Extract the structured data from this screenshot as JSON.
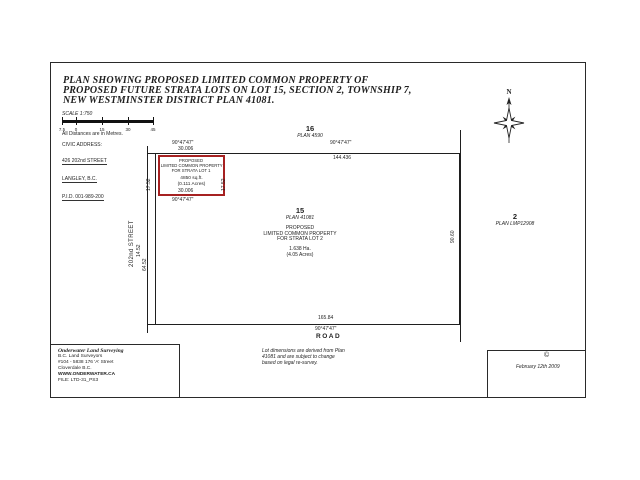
{
  "page": {
    "title_lines": [
      "PLAN SHOWING PROPOSED LIMITED COMMON PROPERTY OF",
      "PROPOSED FUTURE STRATA LOTS ON LOT 15, SECTION 2, TOWNSHIP 7,",
      "NEW WESTMINSTER DISTRICT PLAN 41081."
    ],
    "scale": {
      "label": "SCALE 1:750",
      "ticks": [
        "7.5",
        "0",
        "15",
        "30",
        "45"
      ],
      "note": "All Distances are in Metres."
    },
    "civic": {
      "heading": "CIVIC ADDRESS:",
      "lines": [
        "426 202nd STREET",
        "LANGLEY, B.C.",
        "P.I.D. 001-989-200"
      ]
    }
  },
  "drawing": {
    "north_label": "N",
    "street_label": "202nd STREET",
    "road_label": "ROAD",
    "parcel_north": {
      "number": "16",
      "plan": "PLAN 4590"
    },
    "parcel_east": {
      "number": "2",
      "plan": "PLAN LMP12908"
    },
    "lot15": {
      "number": "15",
      "plan": "PLAN 41081",
      "line1": "PROPOSED",
      "line2": "LIMITED COMMON PROPERTY",
      "line3": "FOR STRATA LOT 2",
      "area_ha": "1.638 Ha.",
      "area_acres": "(4.05 Acres)"
    },
    "lcp_lot1": {
      "line1": "PROPOSED",
      "line2": "LIMITED COMMON PROPERTY",
      "line3": "FOR STRATA LOT 1",
      "area": "4850 sq.ft.",
      "area_acres": "(0.111 Acres)",
      "outline_color": "#a62121"
    },
    "dims": {
      "top_bearing": "90°47'47\"",
      "top_distance": "144.436",
      "box_top_bearing": "90°47'47\"",
      "box_top_distance": "30.006",
      "box_bottom_distance": "30.006",
      "box_bottom_bearing": "90°47'47\"",
      "box_side_left": "17.52",
      "box_side_right": "17.52",
      "street_upper": "14.52",
      "street_lower": "64.52",
      "east_side": "90.60",
      "bottom_distance": "165.84",
      "bottom_bearing": "90°47'47\""
    }
  },
  "footer": {
    "surveyor_lines": [
      "Onderwater Land Surveying",
      "B.C. Land Surveyors",
      "#104 - 5838 176 'A' Street",
      "Cloverdale B.C.",
      "WWW.ONDERWATER.CA",
      "FILE: LTD-31_PS3"
    ],
    "note_lines": [
      "Lot dimensions are derived from Plan",
      "41081 and are subject to change",
      "based on legal re-survey."
    ],
    "copyright_symbol": "©",
    "date": "February 12th 2009"
  }
}
